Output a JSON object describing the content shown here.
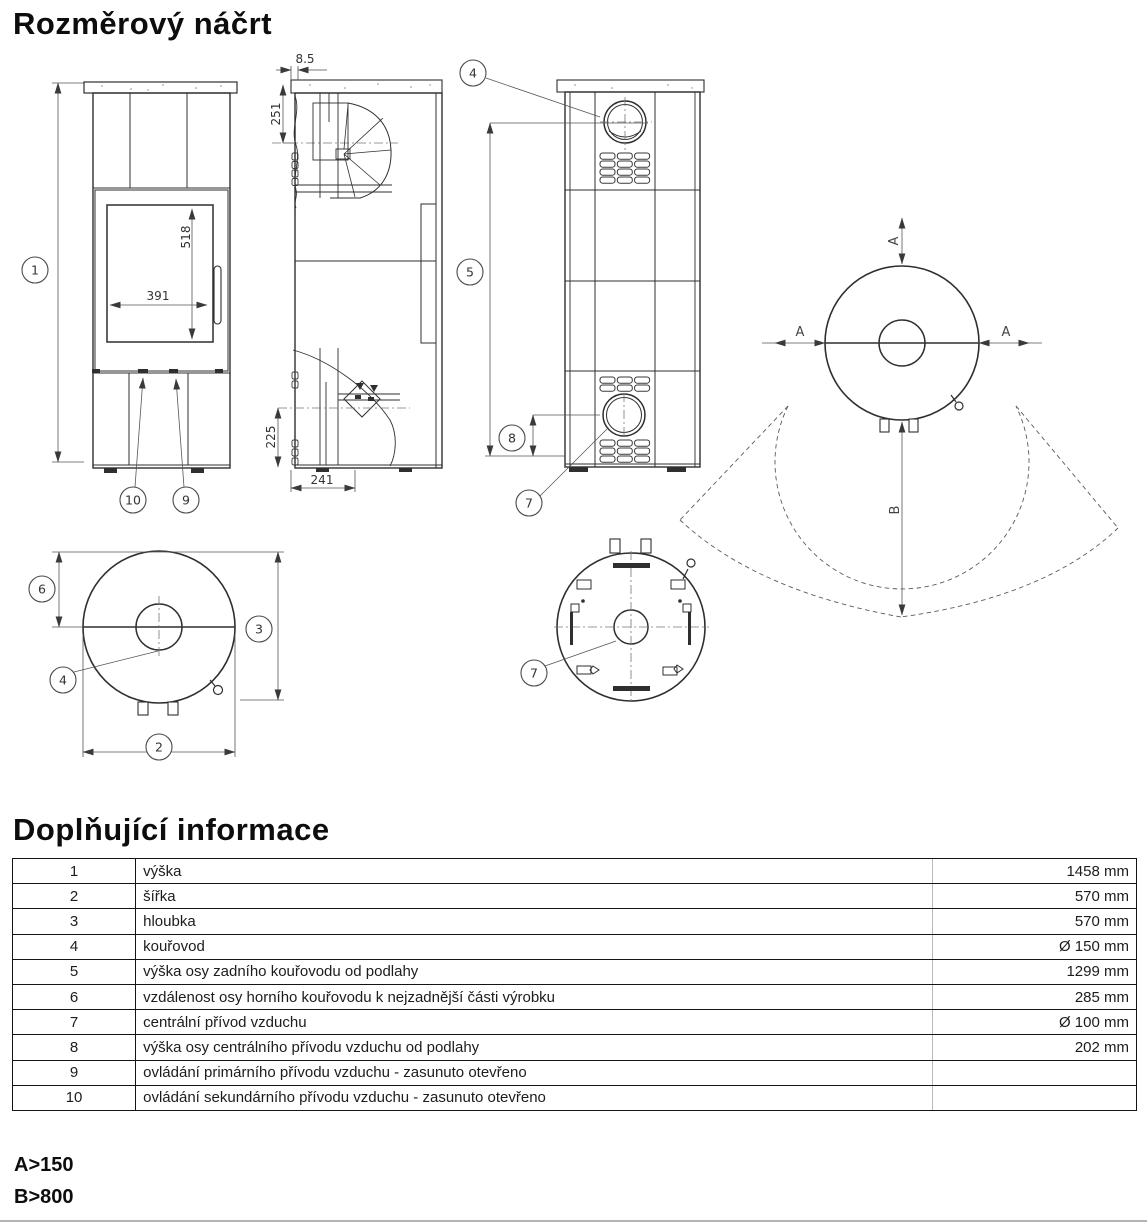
{
  "page": {
    "title": "Rozměrový náčrt",
    "section2_title": "Doplňující informace",
    "note_a": "A>150",
    "note_b": "B>800"
  },
  "drawing": {
    "front": {
      "balloon_1": "1",
      "balloon_9": "9",
      "balloon_10": "10",
      "glass_width": "391",
      "glass_height": "518"
    },
    "side": {
      "dim_top": "8.5",
      "dim_upper": "251",
      "dim_lower": "225",
      "dim_base": "241"
    },
    "rear": {
      "balloon_4": "4",
      "balloon_5": "5",
      "balloon_7": "7",
      "balloon_8": "8"
    },
    "top_view": {
      "balloon_2": "2",
      "balloon_3": "3",
      "balloon_4": "4",
      "balloon_6": "6"
    },
    "bottom_view": {
      "balloon_7": "7"
    },
    "clearance": {
      "label_a": "A",
      "label_b": "B"
    }
  },
  "table": {
    "rows": [
      {
        "num": "1",
        "label": "výška",
        "value": "1458 mm"
      },
      {
        "num": "2",
        "label": "šířka",
        "value": "570 mm"
      },
      {
        "num": "3",
        "label": "hloubka",
        "value": "570 mm"
      },
      {
        "num": "4",
        "label": "kouřovod",
        "value": "Ø 150 mm"
      },
      {
        "num": "5",
        "label": "výška osy zadního kouřovodu od podlahy",
        "value": "1299 mm"
      },
      {
        "num": "6",
        "label": "vzdálenost osy horního kouřovodu k nejzadnější části výrobku",
        "value": "285 mm"
      },
      {
        "num": "7",
        "label": "centrální přívod vzduchu",
        "value": "Ø 100 mm"
      },
      {
        "num": "8",
        "label": "výška osy centrálního přívodu vzduchu od podlahy",
        "value": "202 mm"
      },
      {
        "num": "9",
        "label": "ovládání primárního přívodu vzduchu - zasunuto otevřeno",
        "value": ""
      },
      {
        "num": "10",
        "label": "ovládání sekundárního přívodu vzduchu - zasunuto otevřeno",
        "value": ""
      }
    ]
  }
}
